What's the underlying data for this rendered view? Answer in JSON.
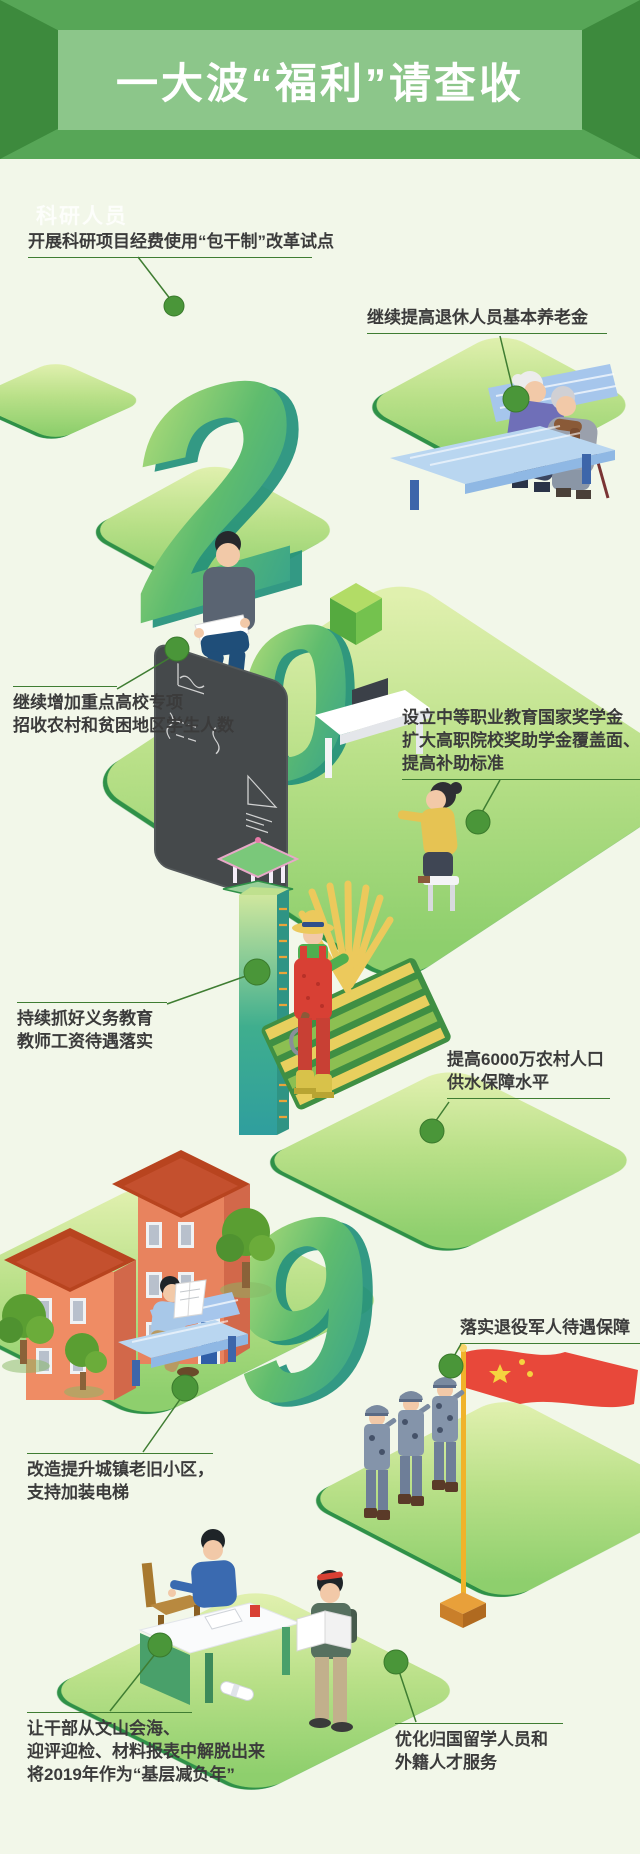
{
  "header": {
    "title": "一大波“福利”请查收"
  },
  "watermark": "科研人员",
  "digits": {
    "d2": "2",
    "d0": "0",
    "d9": "9"
  },
  "callouts": [
    {
      "id": "research-lump-sum",
      "lines": [
        "开展科研项目经费使用“包干制”改革试点"
      ]
    },
    {
      "id": "pension-raise",
      "lines": [
        "继续提高退休人员基本养老金"
      ]
    },
    {
      "id": "university-enroll",
      "lines": [
        "继续增加重点高校专项",
        "招收农村和贫困地区学生人数"
      ]
    },
    {
      "id": "vocational-grant",
      "lines": [
        "设立中等职业教育国家奖学金",
        "扩大高职院校奖助学金覆盖面、",
        "提高补助标准"
      ]
    },
    {
      "id": "teacher-pay",
      "lines": [
        "持续抓好义务教育",
        "教师工资待遇落实"
      ]
    },
    {
      "id": "rural-water",
      "lines": [
        "提高6000万农村人口",
        "供水保障水平"
      ]
    },
    {
      "id": "old-community",
      "lines": [
        "改造提升城镇老旧小区，",
        "支持加装电梯"
      ]
    },
    {
      "id": "veterans-benefit",
      "lines": [
        "落实退役军人待遇保障"
      ]
    },
    {
      "id": "grassroots-burden",
      "lines": [
        "让干部从文山会海、",
        "迎评迎检、材料报表中解脱出来",
        "将2019年作为“基层减负年”"
      ]
    },
    {
      "id": "overseas-talent",
      "lines": [
        "优化归国留学人员和",
        "外籍人才服务"
      ]
    }
  ],
  "colors": {
    "background": "#f2f7e9",
    "banner": "#57a657",
    "banner_panel": "#8cc68a",
    "banner_wing": "#3d8a3d",
    "leader_line": "#3f7d32",
    "dot": "#4a9639",
    "text": "#3b3b3b",
    "platform_edge": "#2f9148",
    "flag_red": "#e8483a",
    "building": "#e8835e",
    "bench_blue": "#b9d6f0"
  },
  "illustrations": [
    "elderly-couple-on-bench",
    "student-sitting-with-paper",
    "blackboard-with-formulas",
    "woman-working-at-laptop-desk",
    "green-cube",
    "water-tower",
    "farmer-with-wheat-sheaf",
    "wheat-field",
    "old-residential-buildings",
    "trees",
    "man-reading-newspaper-on-bench",
    "soldiers-saluting",
    "china-flag",
    "official-writing-at-desk",
    "rolled-document",
    "student-reading-standing"
  ]
}
